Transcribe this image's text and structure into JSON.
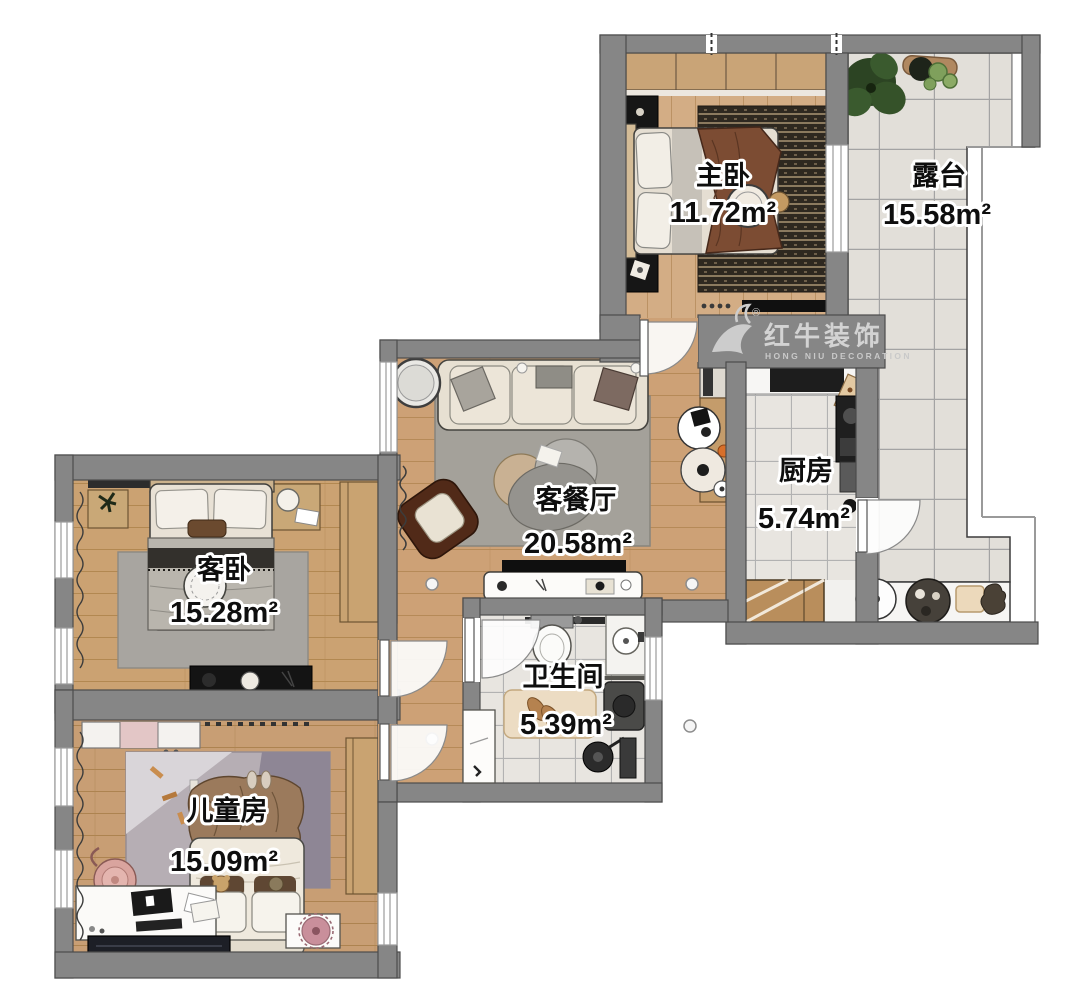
{
  "branding": {
    "logo_text": "红牛装饰",
    "logo_subtext": "HONG NIU DECORATION",
    "registered": "®"
  },
  "rooms": [
    {
      "id": "master-bedroom",
      "name": "主卧",
      "area": "11.72m²"
    },
    {
      "id": "terrace",
      "name": "露台",
      "area": "15.58m²"
    },
    {
      "id": "living-dining",
      "name": "客餐厅",
      "area": "20.58m²"
    },
    {
      "id": "kitchen",
      "name": "厨房",
      "area": "5.74m²"
    },
    {
      "id": "guest-bedroom",
      "name": "客卧",
      "area": "15.28m²"
    },
    {
      "id": "bathroom",
      "name": "卫生间",
      "area": "5.39m²"
    },
    {
      "id": "children-room",
      "name": "儿童房",
      "area": "15.09m²"
    }
  ],
  "colors": {
    "wall": "#868686",
    "wood": "#cda176",
    "tile": "#e2dfd9",
    "label_fill": "#0e0e0e",
    "label_outline": "#ffffff",
    "logo": "#d3d3d3"
  }
}
